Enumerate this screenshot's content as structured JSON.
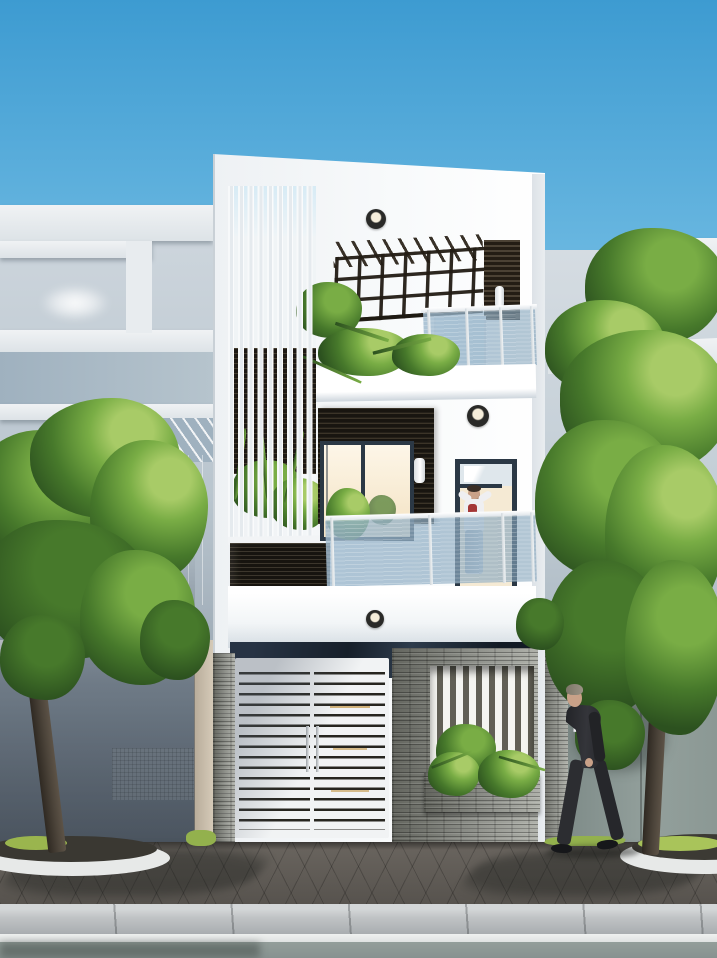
{
  "scene": {
    "type": "architectural-exterior-render",
    "description": "Daytime 3D rendering of a modern three-storey white townhouse facade on a street, flanked by light-grey neighbor houses and two street trees, with a man standing on the second-floor balcony and a man in a suit walking on the paved sidewalk.",
    "sky": {
      "condition": "clear with small clouds near the horizon",
      "cloud_count": 3
    },
    "buildings": {
      "main_house": {
        "storeys": 3,
        "roof_terrace": {
          "parapet": "white cantilevered slab",
          "ceiling_downlight": true,
          "pergola": {
            "material": "dark wood grid",
            "columns": 7,
            "rows": 3,
            "sky_visible_through": true
          },
          "wood_slat_column": true,
          "wall_sconce": true,
          "glass_balustrade": true,
          "planter_with_plants": true
        },
        "second_floor": {
          "vertical_fin_screen": {
            "fin_count": 9,
            "backdrop": "dark wood slats"
          },
          "french_door_panels": 2,
          "interior_light": "warm glow",
          "accent_wall": "dark horizontal slat tile",
          "wall_sconce": true,
          "ceiling_downlight": true,
          "side_door_with_transom": true,
          "balcony_glass_balustrade": true,
          "dark_slat_planter_box": true,
          "balcony_plants": 2
        },
        "ground_floor": {
          "fascia_downlight": true,
          "dark_marble_band": true,
          "gate": {
            "type": "white horizontal-slat double gate",
            "leaves": 2,
            "slats_per_leaf": 16,
            "vertical_handles": 2
          },
          "stone_fence": "grey stacked ledgestone",
          "fence_opening": {
            "vertical_white_slats": 8,
            "planter_with_plants": true
          }
        }
      },
      "left_neighbor": {
        "style": "grey modern house",
        "roof_opening_showing_sky": true,
        "pergola_slats": true,
        "mosaic_texture_band": true
      },
      "right_neighbor": {
        "style": "grey modern house with stacked white slabs",
        "teal_window": true,
        "grey_fence_panel": true,
        "stone_pillar": true
      }
    },
    "street": {
      "sidewalk": "dark diamond-pattern pavers with tree shadows",
      "tree_planters": {
        "count": 2,
        "curb": "white curved edging",
        "grass": true
      },
      "curb": "light concrete blocks",
      "gutter": "white strip",
      "road": "grey-green asphalt"
    },
    "people": [
      {
        "location": "second-floor balcony",
        "pose": "standing, arms raised behind head",
        "clothing": "white shirt with red front detail, light grey trousers"
      },
      {
        "location": "sidewalk, right of gate",
        "pose": "walking to the left",
        "clothing": "dark grey suit, white shirt, blue tie",
        "hair": "grey"
      }
    ],
    "vegetation": {
      "street_trees": 2,
      "tree_crowns": "dense green foliage",
      "facade_planters": 4
    },
    "palette": {
      "sky-top": "#3d9bd1",
      "sky-mid": "#7cc3e7",
      "sky-low": "#cfeaf6",
      "white": "#f7f8f9",
      "white-shade": "#e4e9ed",
      "white-dim": "#d3dae0",
      "dark-slat": "#1d1914",
      "dark-slat-hi": "#453d2f",
      "wood": "#3a3122",
      "frame-dark": "#2b3845",
      "glow": "#f8ecd2",
      "glass": "#9db9ce",
      "glass-deep": "#7fa0b8",
      "stone": "#8e908a",
      "stone-dark": "#63655e",
      "stone-light": "#b0b2ab",
      "marble": "#1c242e",
      "marble-hi": "#3c4c5e",
      "gate-white": "#f1f3f4",
      "gate-gap": "#26251f",
      "gate-gold": "#c9a35c",
      "paver": "#65605a",
      "paver-dark": "#454240",
      "curb": "#c0c3c5",
      "curb-white": "#e7e9e8",
      "gutter": "#eceeed",
      "road": "#8d9894",
      "green-dark": "#2c511f",
      "green": "#47792b",
      "green-light": "#79ad45",
      "green-hi": "#a8cb67",
      "grass": "#93b14d",
      "trunk": "#453c31",
      "nb-light": "#d5dce2",
      "nb-mid": "#b9c5ce",
      "nb-blue": "#9fb1bf",
      "nb-shadow": "#6d7884",
      "fence-panel": "#8b9894",
      "suit": "#2c2d31",
      "skin": "#c9a188",
      "shirt": "#efeff1",
      "tie": "#3a66a8",
      "fixture": "#1b1b1b"
    }
  }
}
